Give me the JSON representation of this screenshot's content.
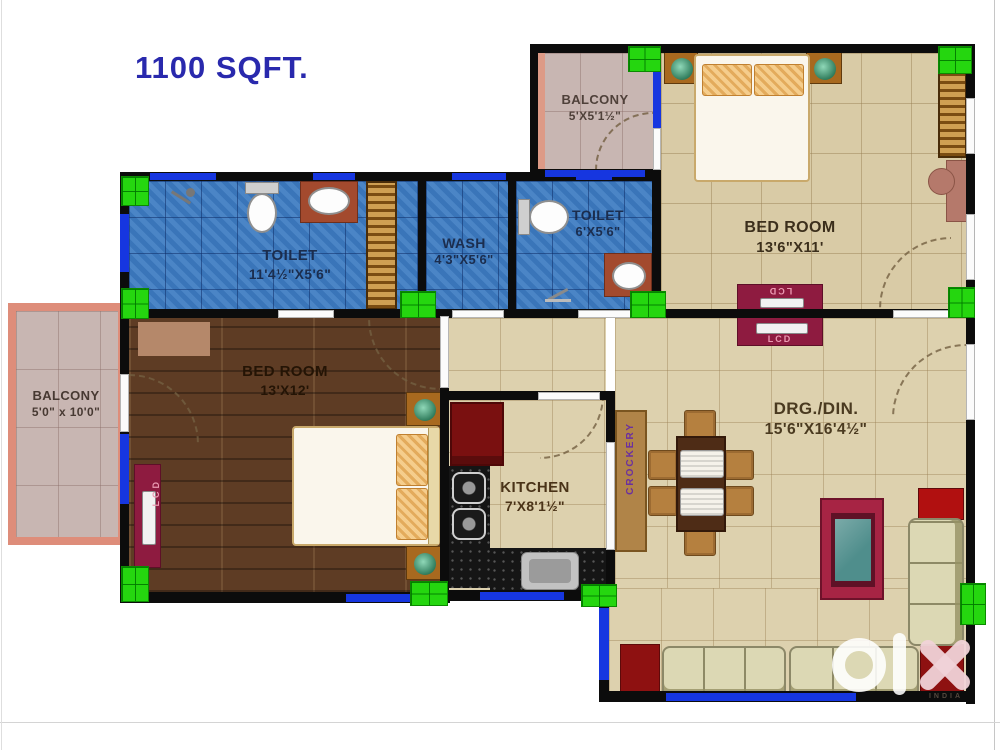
{
  "title": "1100 SQFT.",
  "rooms": {
    "balcony_top": {
      "name": "BALCONY",
      "dims": "5'X5'1½\""
    },
    "bedroom_top": {
      "name": "BED ROOM",
      "dims": "13'6\"X11'"
    },
    "toilet_big": {
      "name": "TOILET",
      "dims": "11'4½\"X5'6\""
    },
    "wash": {
      "name": "WASH",
      "dims": "4'3\"X5'6\""
    },
    "toilet_small": {
      "name": "TOILET",
      "dims": "6'X5'6\""
    },
    "balcony_left": {
      "name": "BALCONY",
      "dims": "5'0\" x 10'0\""
    },
    "bedroom_left": {
      "name": "BED ROOM",
      "dims": "13'X12'"
    },
    "kitchen": {
      "name": "KITCHEN",
      "dims": "7'X8'1½\""
    },
    "drg_din": {
      "name": "DRG./DIN.",
      "dims": "15'6\"X16'4½\""
    }
  },
  "labels": {
    "crockery": "CROCKERY",
    "lcd": "LCD"
  },
  "watermark": {
    "brand": "OLX",
    "country": "INDIA"
  },
  "colors": {
    "wall": "#0c0c0c",
    "window_blue": "#1636e0",
    "column_green": "#25d60f",
    "floor_beige": "#d9cba6",
    "tile_blue": "#3d7cc2",
    "wood_brown": "#5e3c24",
    "balcony_pink": "#c8b6b2",
    "salmon_frame": "#de8d7a",
    "maroon": "#8e1b40",
    "title_blue": "#2929ad"
  }
}
